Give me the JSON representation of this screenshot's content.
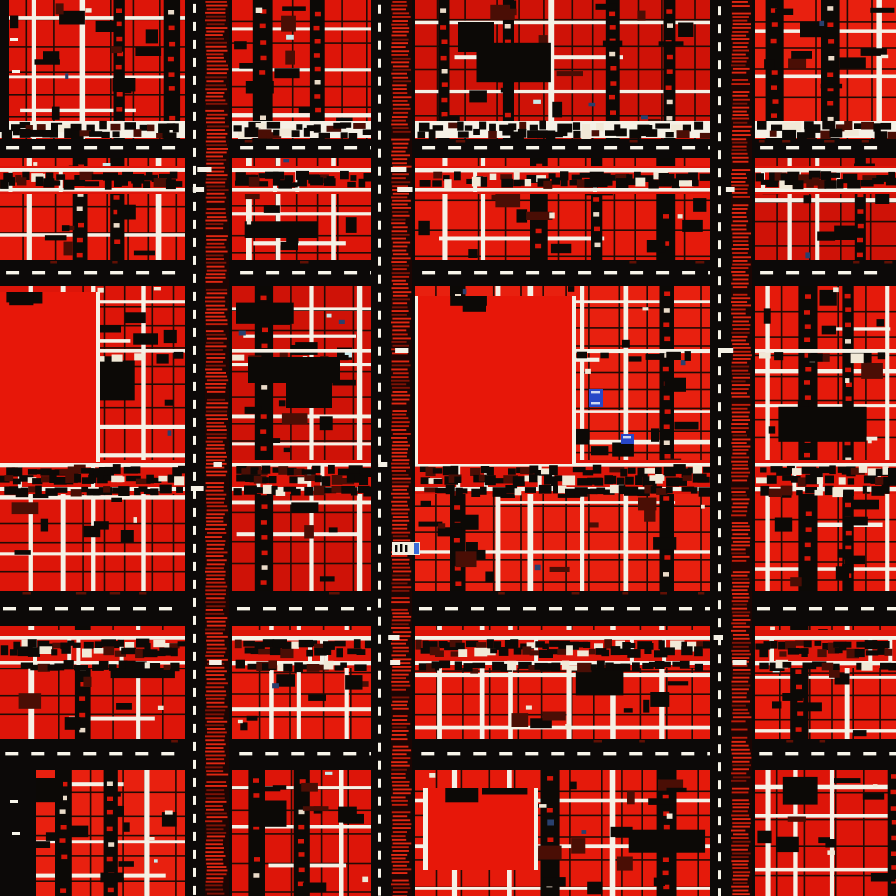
{
  "figure": {
    "alt": "Abstract red, black and white aerial city grid map"
  },
  "scene": {
    "width": 896,
    "height": 896,
    "seed": 1337,
    "palette": {
      "background": "#0b0807",
      "road_black": "#0c0908",
      "block_reds": [
        "#dd1509",
        "#e8200f",
        "#cf1207",
        "#e51a0b"
      ],
      "plaza_red": "#e71709",
      "street_white": "#f5f1e6",
      "dash_white": "#f8f5ea",
      "mark_dark": "#0c0906",
      "mark_maroon": "#4a0e05",
      "thin_dark": "#230b05",
      "speck_white": "#f1e9d7",
      "speck_cyan": "#c9e9ea",
      "speck_blue": "#29406e",
      "dot_red": "#d61508",
      "dot_white": "#eadbc8",
      "hatch_bright": "#e02712",
      "hatch_mid": "#c01c0a",
      "hatch_dim": "#7c1206",
      "hatch_base": "#1c0503",
      "road_speckle": "#611004",
      "marker_blue": "#2747c8",
      "marker_tick": "#cfd8f2",
      "badge_white": "#f2eee1",
      "badge_blue": "#3a6cd8"
    },
    "block_columns": [
      {
        "x": 0,
        "width": 185
      },
      {
        "x": 232,
        "width": 139
      },
      {
        "x": 415,
        "width": 295
      },
      {
        "x": 755,
        "width": 141
      }
    ],
    "block_rows": [
      {
        "y": 0,
        "height": 139
      },
      {
        "y": 158,
        "height": 102
      },
      {
        "y": 286,
        "height": 305
      },
      {
        "y": 626,
        "height": 113
      },
      {
        "y": 770,
        "height": 126
      }
    ],
    "horizontal_roads": [
      {
        "y": 139,
        "height": 19,
        "dash_y": 146
      },
      {
        "y": 260,
        "height": 26,
        "dash_y": 271
      },
      {
        "y": 591,
        "height": 35,
        "dash_y": 607
      },
      {
        "y": 739,
        "height": 31,
        "dash_y": 752
      }
    ],
    "vertical_roads": [
      {
        "x": 185,
        "width": 47,
        "dash_x": 193,
        "hatch_x": 206,
        "hatch_width": 22
      },
      {
        "x": 371,
        "width": 44,
        "dash_x": 378,
        "hatch_x": 392,
        "hatch_width": 19
      },
      {
        "x": 710,
        "width": 45,
        "dash_x": 718,
        "hatch_x": 732,
        "hatch_width": 19
      }
    ],
    "busy_streets": [
      {
        "y": 121,
        "height": 17,
        "base": "white",
        "lines": [],
        "mark_rows": [
          127,
          134
        ],
        "step_min": 6,
        "step_max": 16
      },
      {
        "y": 166,
        "height": 28,
        "base": "red",
        "lines": [
          168,
          188
        ],
        "mark_rows": [
          177,
          183
        ],
        "step_min": 5,
        "step_max": 14
      },
      {
        "y": 347,
        "height": 12,
        "base": "none",
        "lines": [
          349
        ],
        "mark_rows": [
          357
        ],
        "step_min": 14,
        "step_max": 34
      },
      {
        "y": 460,
        "height": 34,
        "base": "red",
        "lines": [
          463,
          487
        ],
        "mark_rows": [
          471,
          480,
          491
        ],
        "step_min": 4,
        "step_max": 11
      },
      {
        "y": 630,
        "height": 38,
        "base": "red",
        "lines": [
          636,
          661
        ],
        "mark_rows": [
          645,
          652,
          666
        ],
        "step_min": 5,
        "step_max": 12
      }
    ],
    "plazas": [
      {
        "x": 0,
        "y": 292,
        "width": 96,
        "height": 170,
        "edge_left": false,
        "edge_right": true
      },
      {
        "x": 418,
        "y": 296,
        "width": 154,
        "height": 168,
        "edge_left": true,
        "edge_right": true
      },
      {
        "x": 428,
        "y": 788,
        "width": 106,
        "height": 82,
        "edge_left": true,
        "edge_right": true
      }
    ],
    "dark_regions": [
      {
        "x": 0,
        "y": 762,
        "width": 36,
        "height": 134
      },
      {
        "x": 0,
        "y": 0,
        "width": 9,
        "height": 132
      }
    ],
    "dark_clusters": [
      {
        "x": 248,
        "y": 357,
        "width": 92,
        "height": 26
      },
      {
        "x": 286,
        "y": 358,
        "width": 46,
        "height": 50
      },
      {
        "x": 458,
        "y": 22,
        "width": 36,
        "height": 30
      }
    ],
    "markers": [
      {
        "x": 589,
        "y": 389,
        "width": 14,
        "height": 18,
        "ticks": 2
      },
      {
        "x": 621,
        "y": 434,
        "width": 13,
        "height": 10,
        "ticks": 1
      }
    ],
    "badge": {
      "x": 392,
      "y": 542,
      "width": 28,
      "height": 13
    },
    "texture": {
      "strip_min": 22,
      "strip_max": 54,
      "alley_min": 11,
      "alley_max": 20,
      "hline_gap_min": 26,
      "hline_gap_max": 62,
      "thin_v_gap_min": 20,
      "thin_v_gap_max": 34,
      "thin_h_gap_min": 17,
      "thin_h_gap_max": 30,
      "dot_step": 13,
      "mark_density": 2100,
      "speck_density": 8200,
      "h_dash_len": 13,
      "h_dash_gap": 13,
      "h_dash_h": 3.4,
      "v_dash_len": 9,
      "v_dash_gap": 9,
      "v_dash_w": 3,
      "hatch_step": 3.4,
      "hatch_tick_h": 1.9
    }
  }
}
